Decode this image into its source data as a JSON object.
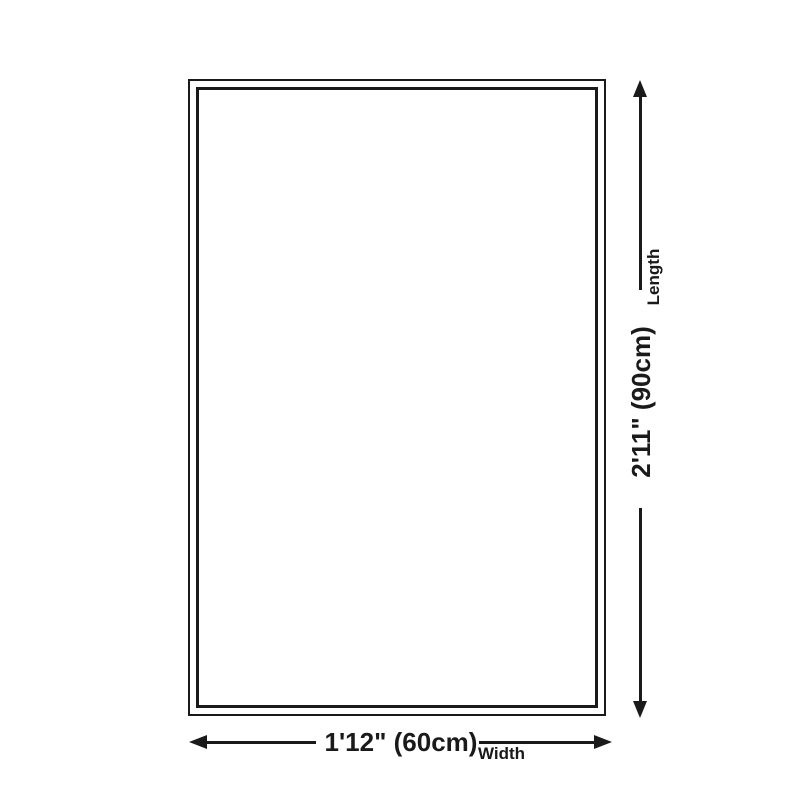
{
  "diagram": {
    "background_color": "#ffffff",
    "line_color": "#1a1a1a",
    "shape": "rectangle-double-border",
    "length": {
      "value": "2'11\" (90cm)",
      "label": "Length"
    },
    "width": {
      "value": "1'12\" (60cm)",
      "label": "Width"
    }
  }
}
